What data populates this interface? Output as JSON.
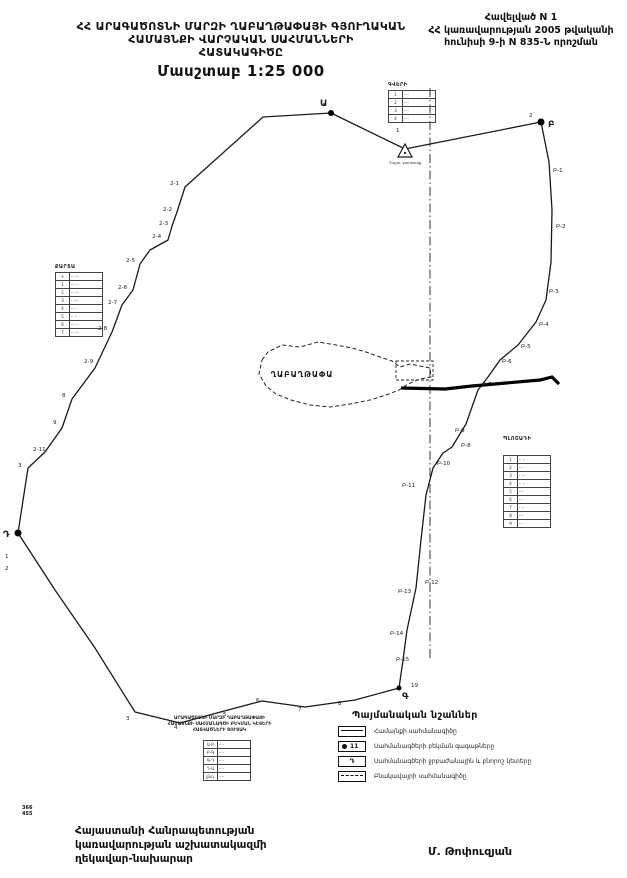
{
  "doc": {
    "title_lines": [
      "ՀՀ  ԱՐԱԳԱԾՈՏՆԻ ՄԱՐԶԻ ՂԱԲԱՂԹԱՓԱՅԻ ԳՅՈՒՂԱԿԱՆ",
      "ՀԱՄԱՅՆՔԻ ՎԱՐՉԱԿԱՆ ՍԱՀՄԱՆՆԵՐԻ",
      "ՀԱՏԱԿԱԳԻԾԸ"
    ],
    "scale_label": "Մասշտաբ 1:25 000",
    "appendix_lines": [
      "Հավելված N 1",
      "ՀՀ կառավարության 2005 թվականի",
      "հունիսի 9-ի N 835-Ն որոշման"
    ],
    "footer_left_lines": [
      "Հայաստանի Հանրապետության",
      "կառավարության աշխատակազմի",
      "ղեկավար-նախարար"
    ],
    "signature_name": "Մ. Թոփուզյան",
    "margin_numbers": [
      "366",
      "455"
    ]
  },
  "legend": {
    "title": "Պայմանական նշաններ",
    "items": [
      {
        "icon": "solid-line-box",
        "label": "Համայնքի սահմանագիծը"
      },
      {
        "icon": "dot-number-box",
        "icon_number": "11",
        "label": "Սահմանագծերի բեկման գագաթները"
      },
      {
        "icon": "letter-box",
        "icon_letter": "Դ",
        "label": "Սահմանագծերի ջրբաժանային և բնորոշ կետերը"
      },
      {
        "icon": "dashed-line-box",
        "label": "Բնակավայրի սահմանագիծը"
      }
    ]
  },
  "map": {
    "settlement_label": "ՂԱԲԱՂԹԱՓԱ",
    "triangle_caption": "Դաշտ. բարձունք",
    "boundary_points": [
      [
        331,
        113
      ],
      [
        405,
        149
      ],
      [
        541,
        122
      ],
      [
        549,
        162
      ],
      [
        552,
        210
      ],
      [
        551,
        262
      ],
      [
        546,
        300
      ],
      [
        536,
        322
      ],
      [
        518,
        345
      ],
      [
        500,
        360
      ],
      [
        488,
        377
      ],
      [
        478,
        390
      ],
      [
        466,
        424
      ],
      [
        452,
        447
      ],
      [
        443,
        453
      ],
      [
        433,
        468
      ],
      [
        426,
        495
      ],
      [
        421,
        540
      ],
      [
        416,
        588
      ],
      [
        407,
        630
      ],
      [
        403,
        660
      ],
      [
        399,
        688
      ],
      [
        355,
        700
      ],
      [
        305,
        707
      ],
      [
        262,
        701
      ],
      [
        228,
        710
      ],
      [
        180,
        723
      ],
      [
        135,
        712
      ],
      [
        95,
        648
      ],
      [
        55,
        590
      ],
      [
        18,
        533
      ],
      [
        28,
        468
      ],
      [
        45,
        452
      ],
      [
        62,
        428
      ],
      [
        72,
        399
      ],
      [
        95,
        368
      ],
      [
        112,
        332
      ],
      [
        122,
        305
      ],
      [
        133,
        290
      ],
      [
        140,
        264
      ],
      [
        150,
        250
      ],
      [
        168,
        240
      ],
      [
        172,
        226
      ],
      [
        177,
        212
      ],
      [
        185,
        187
      ],
      [
        263,
        117
      ]
    ],
    "settlement_points": [
      [
        262,
        360
      ],
      [
        268,
        352
      ],
      [
        282,
        345
      ],
      [
        300,
        347
      ],
      [
        318,
        342
      ],
      [
        336,
        345
      ],
      [
        352,
        348
      ],
      [
        366,
        352
      ],
      [
        380,
        357
      ],
      [
        392,
        361
      ],
      [
        400,
        367
      ],
      [
        410,
        364
      ],
      [
        420,
        366
      ],
      [
        430,
        368
      ],
      [
        431,
        377
      ],
      [
        420,
        379
      ],
      [
        408,
        384
      ],
      [
        399,
        390
      ],
      [
        386,
        395
      ],
      [
        370,
        400
      ],
      [
        350,
        404
      ],
      [
        330,
        407
      ],
      [
        310,
        405
      ],
      [
        291,
        400
      ],
      [
        276,
        394
      ],
      [
        266,
        386
      ],
      [
        259,
        374
      ]
    ],
    "axis_line": {
      "x": 430,
      "y1": 88,
      "y2": 660
    },
    "thick_line_points": [
      [
        401,
        388
      ],
      [
        445,
        389
      ],
      [
        472,
        386
      ],
      [
        540,
        380
      ],
      [
        552,
        377
      ],
      [
        559,
        384
      ]
    ],
    "dashed_rect": {
      "x": 396,
      "y": 361,
      "w": 37,
      "h": 19
    },
    "triangle": {
      "x": 405,
      "y": 152
    },
    "nodes": [
      {
        "label": "Ա",
        "x": 331,
        "y": 113,
        "lx": 320,
        "ly": 106,
        "r": 3
      },
      {
        "label": "Բ",
        "x": 541,
        "y": 122,
        "lx": 548,
        "ly": 127,
        "r": 3.5
      },
      {
        "label": "Գ",
        "x": 399,
        "y": 688,
        "lx": 402,
        "ly": 699,
        "r": 2.5
      },
      {
        "label": "Դ",
        "x": 18,
        "y": 533,
        "lx": 3,
        "ly": 537,
        "r": 3.5
      }
    ],
    "vertex_labels": [
      {
        "t": "1",
        "x": 396,
        "y": 132
      },
      {
        "t": "2",
        "x": 529,
        "y": 117
      },
      {
        "t": "2-1",
        "x": 170,
        "y": 185
      },
      {
        "t": "2-2",
        "x": 163,
        "y": 211
      },
      {
        "t": "2-3",
        "x": 159,
        "y": 225
      },
      {
        "t": "2-4",
        "x": 152,
        "y": 238
      },
      {
        "t": "2-5",
        "x": 126,
        "y": 262
      },
      {
        "t": "2-6",
        "x": 118,
        "y": 289
      },
      {
        "t": "2-7",
        "x": 108,
        "y": 304
      },
      {
        "t": "2-8",
        "x": 98,
        "y": 330
      },
      {
        "t": "2-9",
        "x": 84,
        "y": 363
      },
      {
        "t": "8",
        "x": 62,
        "y": 397
      },
      {
        "t": "9",
        "x": 53,
        "y": 424
      },
      {
        "t": "2-11",
        "x": 33,
        "y": 451
      },
      {
        "t": "3",
        "x": 18,
        "y": 467
      },
      {
        "t": "1",
        "x": 5,
        "y": 558
      },
      {
        "t": "2",
        "x": 5,
        "y": 570
      },
      {
        "t": "3",
        "x": 126,
        "y": 720
      },
      {
        "t": "4",
        "x": 174,
        "y": 729
      },
      {
        "t": "5",
        "x": 223,
        "y": 716
      },
      {
        "t": "6",
        "x": 256,
        "y": 702
      },
      {
        "t": "7",
        "x": 298,
        "y": 711
      },
      {
        "t": "8",
        "x": 338,
        "y": 705
      },
      {
        "t": "19",
        "x": 411,
        "y": 687
      },
      {
        "t": "Բ-1",
        "x": 553,
        "y": 172
      },
      {
        "t": "Բ-2",
        "x": 556,
        "y": 228
      },
      {
        "t": "Բ-3",
        "x": 549,
        "y": 293
      },
      {
        "t": "Բ-4",
        "x": 539,
        "y": 326
      },
      {
        "t": "Բ-5",
        "x": 521,
        "y": 348
      },
      {
        "t": "Բ-6",
        "x": 502,
        "y": 363
      },
      {
        "t": "Բ-7",
        "x": 482,
        "y": 386
      },
      {
        "t": "Բ-8",
        "x": 461,
        "y": 447
      },
      {
        "t": "Բ-9",
        "x": 455,
        "y": 432
      },
      {
        "t": "Բ-10",
        "x": 437,
        "y": 465
      },
      {
        "t": "Բ-11",
        "x": 402,
        "y": 487
      },
      {
        "t": "Բ-12",
        "x": 425,
        "y": 584
      },
      {
        "t": "Բ-13",
        "x": 398,
        "y": 593
      },
      {
        "t": "Բ-14",
        "x": 390,
        "y": 635
      },
      {
        "t": "Բ-15",
        "x": 396,
        "y": 661
      }
    ],
    "colors": {
      "ink": "#1a1a1a"
    }
  },
  "tables": {
    "left": {
      "header": "ՔԱՐՏԱ",
      "rows": [
        [
          "+",
          "·· ···"
        ],
        [
          "1",
          "··· ··"
        ],
        [
          "2",
          "·· ···"
        ],
        [
          "3",
          "· ····"
        ],
        [
          "4",
          "··· ·"
        ],
        [
          "5",
          "·· ··"
        ],
        [
          "6",
          "··· ··"
        ],
        [
          "7",
          "·· ···"
        ]
      ]
    },
    "top": {
      "header": "ԳՎԵՐԻ",
      "rows": [
        [
          "1",
          "····"
        ],
        [
          "2",
          "····"
        ],
        [
          "3",
          "····"
        ],
        [
          "4",
          "····"
        ]
      ]
    },
    "right": {
      "header": "ՊԼՈՇԱԴԻ",
      "rows": [
        [
          "1",
          "·· ··"
        ],
        [
          "2",
          "·· ·"
        ],
        [
          "3",
          "· ···"
        ],
        [
          "4",
          "·· ··"
        ],
        [
          "5",
          "····"
        ],
        [
          "6",
          "·· ·"
        ],
        [
          "7",
          "· ··"
        ],
        [
          "8",
          "····"
        ],
        [
          "9",
          "·· ·"
        ]
      ]
    },
    "bottom": {
      "caption_lines": [
        "ԱՐԱԳԱԾՈՏՆԻ ՄԱՐԶԻ ՂԱԲԱՂԹԱՓԱՅԻ",
        "ՀԱՄԱՅՆՔԻ ՍԱՀՄԱՆԱԳԾԻ ԲԵԿՄԱՆ ԿԵՏԵՐԻ",
        "ՀԱՏՎԱԾՆԵՐԻ ՑՈՒՑԱԿ"
      ],
      "rows": [
        [
          "Ա-Բ",
          "····"
        ],
        [
          "Բ-Գ",
          "····"
        ],
        [
          "Գ-Դ",
          "····"
        ],
        [
          "Դ-Ա",
          "····"
        ],
        [
          "ընդ.",
          "····"
        ]
      ]
    }
  }
}
